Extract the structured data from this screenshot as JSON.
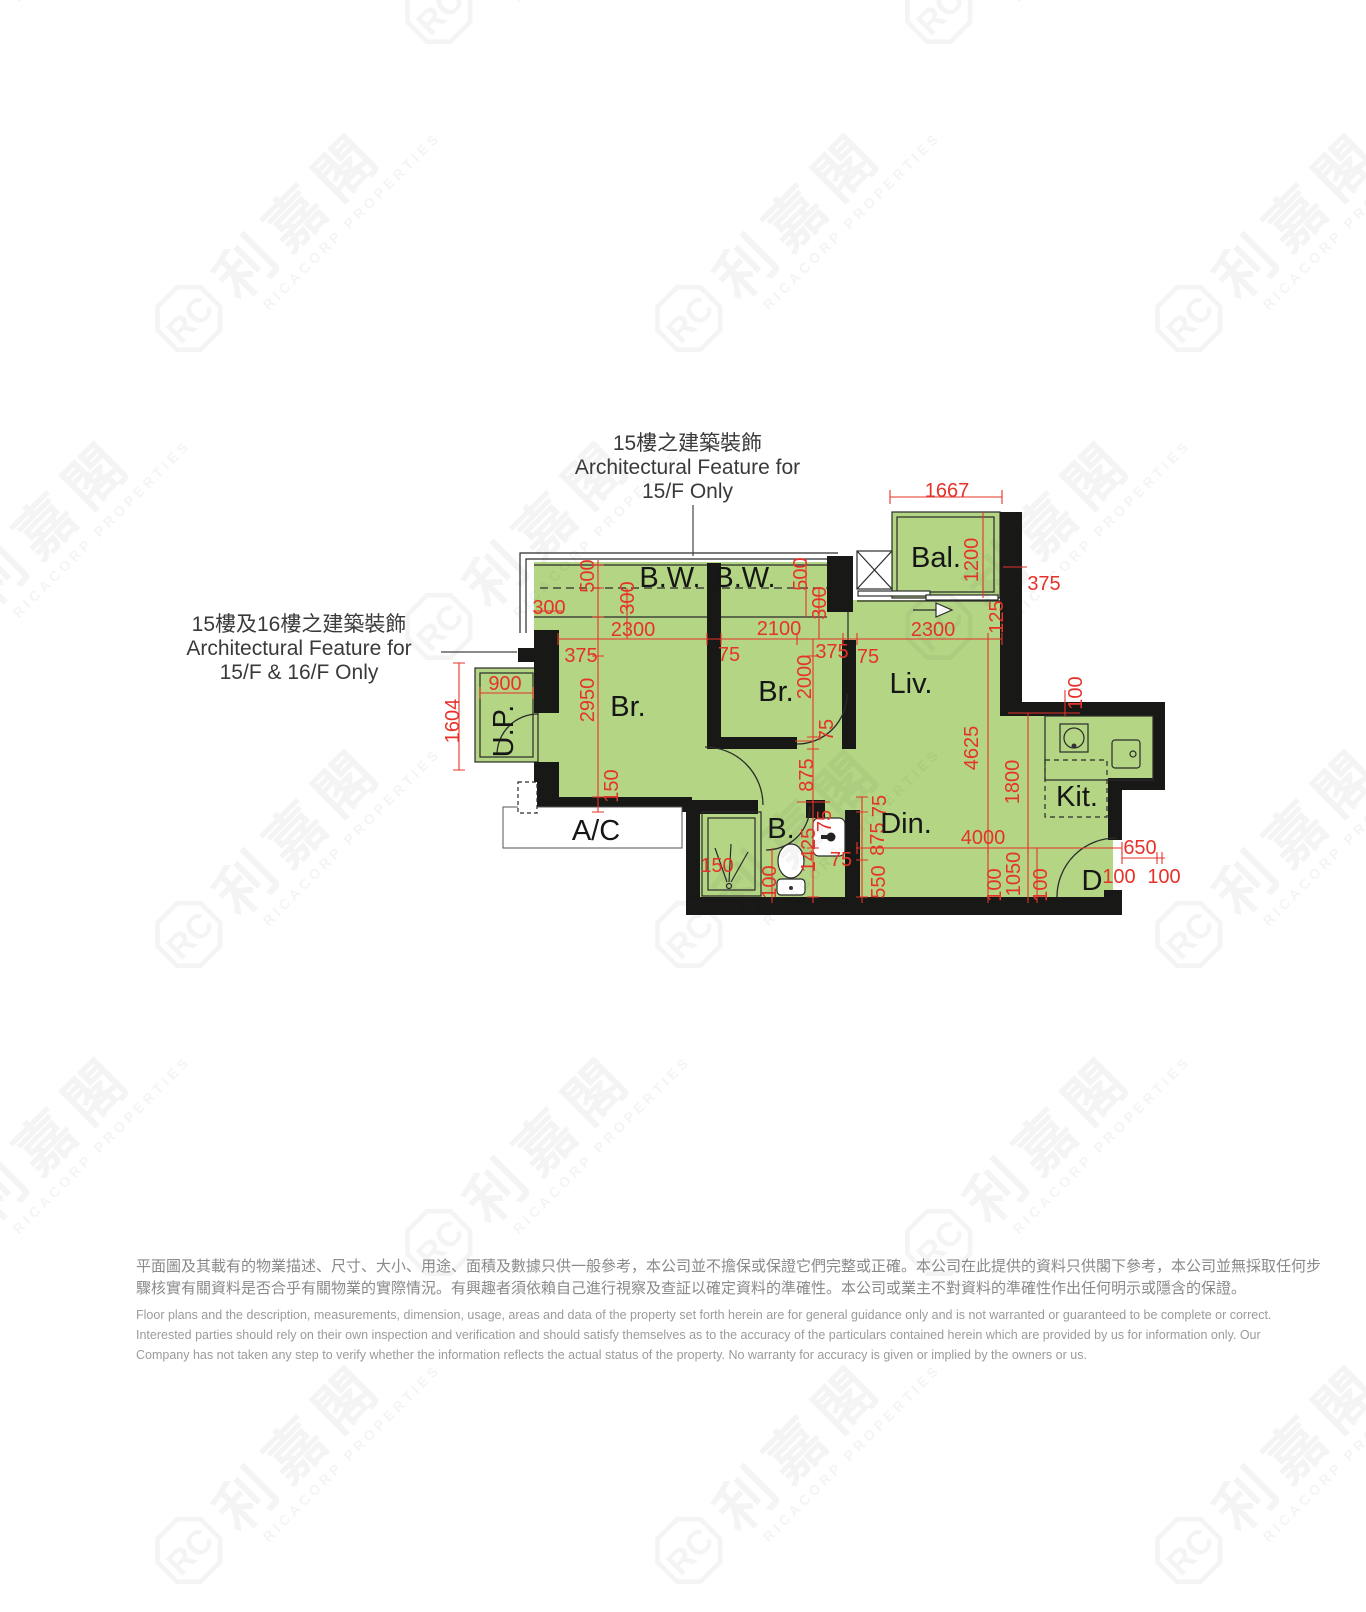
{
  "annotations": {
    "top": {
      "line1": "15樓之建築裝飾",
      "line2": "Architectural Feature for",
      "line3": "15/F Only"
    },
    "left": {
      "line1": "15樓及16樓之建築裝飾",
      "line2": "Architectural Feature for",
      "line3": "15/F & 16/F Only"
    }
  },
  "plan": {
    "unit_label": "D",
    "rooms": {
      "bw1": "B.W.",
      "bw2": "B.W.",
      "br1": "Br.",
      "br2": "Br.",
      "liv": "Liv.",
      "din": "Din.",
      "kit": "Kit.",
      "bath": "B.",
      "bal": "Bal.",
      "up": "U.P.",
      "ac": "A/C"
    },
    "dims": {
      "bal_w": "1667",
      "bal_h": "1200",
      "bal_wall": "375",
      "liv_gap": "125",
      "br1_w": "2300",
      "br2_w": "2100",
      "liv_w": "2300",
      "w375a": "375",
      "w75a": "75",
      "w375b": "375",
      "w75b": "75",
      "bw_l500": "500",
      "bw_l300": "300",
      "bw_l300h": "300",
      "bw_r500": "500",
      "bw_r300": "300",
      "up_w": "900",
      "up_h": "1604",
      "br1_h": "2950",
      "br1_wall": "150",
      "br2_h": "2000",
      "w75c": "75",
      "hall_h": "875",
      "bath_h": "1425",
      "w75e": "75",
      "shower_w": "150",
      "bath_100": "100",
      "w75f": "75",
      "w75g": "75",
      "din_875": "875",
      "din_550": "550",
      "liv_h": "4625",
      "kit_h": "1800",
      "kit_100": "100",
      "din_w": "4000",
      "ent_1050": "1050",
      "ent_100a": "100",
      "ent_100b": "100",
      "door_650": "650",
      "door_100a": "100",
      "door_100b": "100"
    }
  },
  "watermark": {
    "cjk": "利嘉閣",
    "en": "RICACORP PROPERTIES",
    "logo_text": "RC"
  },
  "disclaimer": {
    "zh1": "平面圖及其載有的物業描述、尺寸、大小、用途、面積及數據只供一般參考，本公司並不擔保或保證它們完整或正確。本公司在此提供的資料只供閣下參考，本公司並無採取任何步",
    "zh2": "驟核實有關資料是否合乎有關物業的實際情況。有興趣者須依賴自己進行視察及查証以確定資料的準確性。本公司或業主不對資料的準確性作出任何明示或隱含的保證。",
    "en1": "Floor plans and the description, measurements, dimension, usage, areas and data of the property set forth herein are for general guidance only and is not warranted or guaranteed to be complete or correct.",
    "en2": "Interested parties should rely on their own inspection and verification and should satisfy themselves as to the accuracy of the particulars contained herein which are provided by us for information only.  Our",
    "en3": "Company has not taken any step to verify whether the information reflects the actual status of the property.  No warranty for accuracy is given or implied by the owners or us."
  },
  "colors": {
    "floor": "#b3d584",
    "wall": "#181816",
    "dim_red": "#e6332a",
    "line": "#2b2b2b"
  }
}
